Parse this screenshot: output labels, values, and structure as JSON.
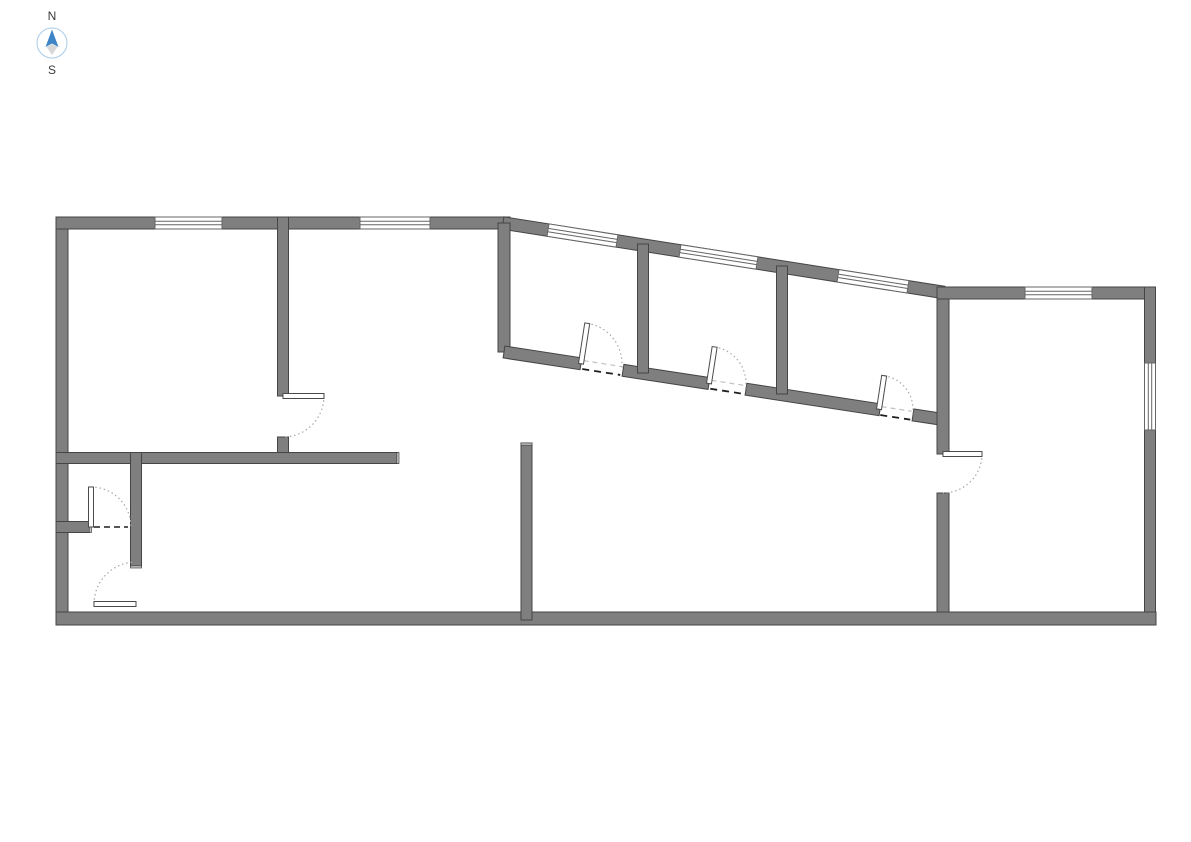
{
  "compass": {
    "north_label": "N",
    "south_label": "S",
    "circle_color": "#a9cbe8",
    "needle_north_color": "#3d85c6",
    "needle_south_color": "#d8d8d8",
    "label_color": "#3a3a3a"
  },
  "palette": {
    "background": "#ffffff",
    "wall_fill": "#7f7f7f",
    "wall_stroke": "#454545",
    "wall_end_cap": "#c4c4c4",
    "window_fill": "#ffffff",
    "window_stroke": "#666666",
    "door_leaf_fill": "#ffffff",
    "door_leaf_stroke": "#4a4a4a",
    "door_arc_color": "#a8a8a8",
    "threshold_dark": "#1f1f1f",
    "threshold_light": "#c2c2c2"
  },
  "plan": {
    "walls": [
      {
        "name": "exterior-west",
        "x1": 62,
        "y1": 217,
        "x2": 62,
        "y2": 625,
        "w": 12
      },
      {
        "name": "exterior-north",
        "x1": 56,
        "y1": 223,
        "x2": 510,
        "y2": 223,
        "w": 12
      },
      {
        "name": "exterior-north-slanted",
        "x1": 503,
        "y1": 223,
        "x2": 944,
        "y2": 292.5,
        "w": 12.5
      },
      {
        "name": "upper-hall-west",
        "x1": 504,
        "y1": 223,
        "x2": 504,
        "y2": 352,
        "w": 12
      },
      {
        "name": "slanted-south-a",
        "x1": 504,
        "y1": 352,
        "x2": 581,
        "y2": 363.8,
        "w": 12
      },
      {
        "name": "slanted-south-b",
        "x1": 623,
        "y1": 370.3,
        "x2": 709,
        "y2": 383.5,
        "w": 12
      },
      {
        "name": "slanted-south-c",
        "x1": 746,
        "y1": 389.2,
        "x2": 880,
        "y2": 409.8,
        "w": 12
      },
      {
        "name": "slanted-south-d",
        "x1": 913,
        "y1": 414.9,
        "x2": 944,
        "y2": 419.6,
        "w": 12
      },
      {
        "name": "right-room-west-upper",
        "x1": 943,
        "y1": 288,
        "x2": 943,
        "y2": 454,
        "w": 12
      },
      {
        "name": "right-room-west-lower",
        "x1": 943,
        "y1": 493,
        "x2": 943,
        "y2": 624,
        "w": 12
      },
      {
        "name": "right-room-north",
        "x1": 937,
        "y1": 293,
        "x2": 1155,
        "y2": 293,
        "w": 12
      },
      {
        "name": "exterior-east",
        "x1": 1150,
        "y1": 287,
        "x2": 1150,
        "y2": 625,
        "w": 11
      },
      {
        "name": "exterior-south",
        "x1": 56,
        "y1": 618.5,
        "x2": 1156,
        "y2": 618.5,
        "w": 13
      },
      {
        "name": "west-room-east",
        "x1": 283,
        "y1": 217,
        "x2": 283,
        "y2": 396,
        "w": 11
      },
      {
        "name": "west-room-east-stub",
        "x1": 283,
        "y1": 437,
        "x2": 283,
        "y2": 461,
        "w": 11
      },
      {
        "name": "mid-horizontal",
        "x1": 56,
        "y1": 458,
        "x2": 398,
        "y2": 458,
        "w": 11
      },
      {
        "name": "small-room-east",
        "x1": 136,
        "y1": 452.5,
        "x2": 136,
        "y2": 566.5,
        "w": 11
      },
      {
        "name": "small-room-stub",
        "x1": 56,
        "y1": 527,
        "x2": 89.5,
        "y2": 527,
        "w": 11
      },
      {
        "name": "center-vertical",
        "x1": 526.5,
        "y1": 443,
        "x2": 526.5,
        "y2": 620,
        "w": 11
      },
      {
        "name": "upper-partition-1",
        "x1": 643,
        "y1": 244,
        "x2": 643,
        "y2": 373,
        "w": 11
      },
      {
        "name": "upper-partition-2",
        "x1": 782,
        "y1": 266,
        "x2": 782,
        "y2": 394,
        "w": 11
      }
    ],
    "end_caps": [
      {
        "name": "cap-mid-horizontal-end",
        "x": 396.8,
        "y": 452.5,
        "w": 2.2,
        "h": 11
      },
      {
        "name": "cap-center-vertical-top",
        "x": 521,
        "y": 443,
        "w": 11,
        "h": 2.2
      },
      {
        "name": "cap-small-room-east-bottom",
        "x": 130.5,
        "y": 565.8,
        "w": 11,
        "h": 2.2
      },
      {
        "name": "cap-small-room-stub-end",
        "x": 89.3,
        "y": 521.5,
        "w": 2.2,
        "h": 11
      }
    ],
    "windows": [
      {
        "name": "window-north-1",
        "x1": 155,
        "y1": 223,
        "x2": 222,
        "y2": 223,
        "w": 12
      },
      {
        "name": "window-north-2",
        "x1": 360,
        "y1": 223,
        "x2": 430,
        "y2": 223,
        "w": 12
      },
      {
        "name": "window-slanted-1",
        "x1": 548,
        "y1": 230.1,
        "x2": 617,
        "y2": 241,
        "w": 12.5
      },
      {
        "name": "window-slanted-2",
        "x1": 680,
        "y1": 250.9,
        "x2": 757,
        "y2": 263,
        "w": 12.5
      },
      {
        "name": "window-slanted-3",
        "x1": 838,
        "y1": 275.8,
        "x2": 908,
        "y2": 286.8,
        "w": 12.5
      },
      {
        "name": "window-right-room-north",
        "x1": 1025,
        "y1": 293,
        "x2": 1092,
        "y2": 293,
        "w": 12
      },
      {
        "name": "window-east",
        "x1": 1150,
        "y1": 363,
        "x2": 1150,
        "y2": 430,
        "w": 11
      }
    ],
    "doors": [
      {
        "name": "door-upper-room-1",
        "hx": 581,
        "hy": 363.8,
        "r": 41,
        "leaf_deg": -81.25,
        "arc_start_deg": -81.25,
        "arc_end_deg": 8.75
      },
      {
        "name": "door-upper-room-2",
        "hx": 709,
        "hy": 383.5,
        "r": 37,
        "leaf_deg": -81.25,
        "arc_start_deg": -81.25,
        "arc_end_deg": 8.75
      },
      {
        "name": "door-upper-room-3",
        "hx": 879,
        "hy": 409.3,
        "r": 34,
        "leaf_deg": -81.25,
        "arc_start_deg": -81.25,
        "arc_end_deg": 8.75
      },
      {
        "name": "door-west-room",
        "hx": 283,
        "hy": 396,
        "r": 41,
        "leaf_deg": 0,
        "arc_start_deg": 0,
        "arc_end_deg": 90
      },
      {
        "name": "door-right-room",
        "hx": 943,
        "hy": 454,
        "r": 39,
        "leaf_deg": 0,
        "arc_start_deg": 0,
        "arc_end_deg": 90
      },
      {
        "name": "door-small-room-inner",
        "hx": 91,
        "hy": 527,
        "r": 40,
        "leaf_deg": -90,
        "arc_start_deg": -90,
        "arc_end_deg": 0
      },
      {
        "name": "door-small-room-outer",
        "hx": 136,
        "hy": 604,
        "r": 42,
        "leaf_deg": 180,
        "arc_start_deg": 180,
        "arc_end_deg": 268
      }
    ],
    "thresholds": [
      {
        "name": "threshold-upper-room-1",
        "x1": 583,
        "y1": 364.1,
        "x2": 621,
        "y2": 370,
        "style": "double"
      },
      {
        "name": "threshold-upper-room-2",
        "x1": 711,
        "y1": 383.8,
        "x2": 744,
        "y2": 388.9,
        "style": "double"
      },
      {
        "name": "threshold-upper-room-3",
        "x1": 881,
        "y1": 410.1,
        "x2": 911,
        "y2": 414.7,
        "style": "double"
      },
      {
        "name": "threshold-small-room-inner",
        "x1": 94,
        "y1": 527,
        "x2": 128,
        "y2": 527,
        "style": "single"
      }
    ]
  }
}
